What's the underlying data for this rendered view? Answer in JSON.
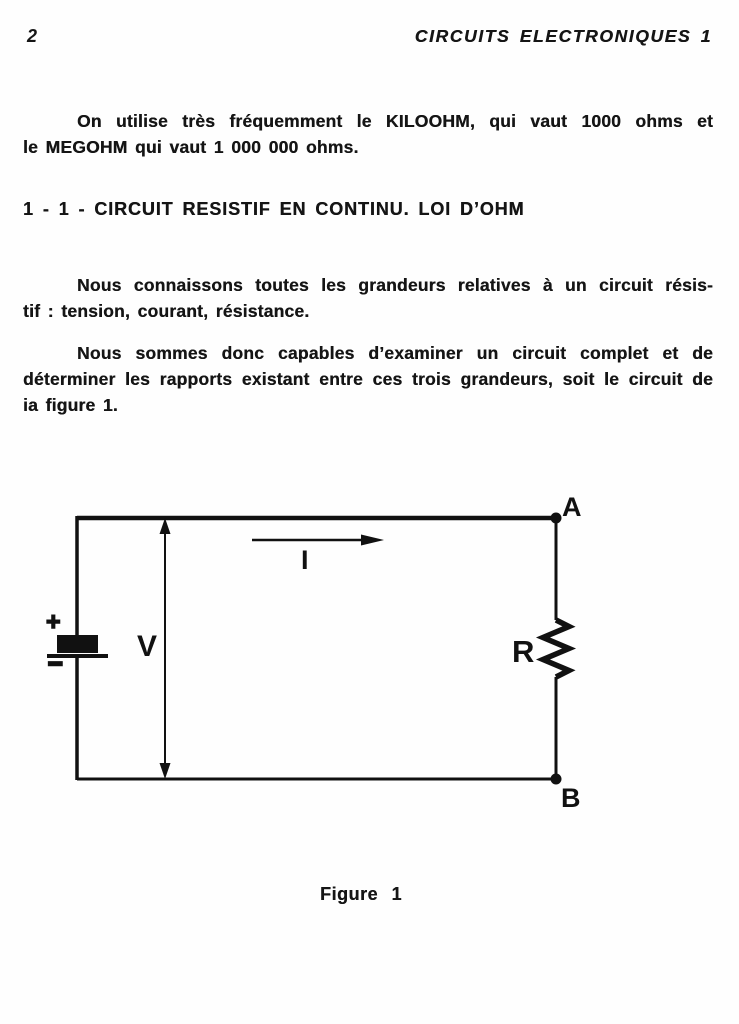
{
  "header": {
    "page_number": "2",
    "running_title": "CIRCUITS ELECTRONIQUES 1"
  },
  "intro_paragraph": {
    "line1": "On utilise très fréquemment le KILOOHM, qui vaut 1000 ohms et",
    "line2": "le MEGOHM qui vaut 1 000 000 ohms."
  },
  "section_heading": "1 - 1 - CIRCUIT RESISTIF EN CONTINU. LOI D’OHM",
  "paragraph_grandeurs": {
    "line1": "Nous connaissons toutes les grandeurs relatives à un circuit résis-",
    "line2": "tif : tension, courant, résistance."
  },
  "paragraph_circuit": {
    "line1": "Nous sommes donc capables d’examiner un circuit complet et de",
    "line2": "déterminer les rapports existant entre ces trois grandeurs, soit le circuit de",
    "line3": "ia figure 1."
  },
  "figure": {
    "caption": "Figure 1",
    "labels": {
      "node_a": "A",
      "node_b": "B",
      "voltage": "V",
      "current": "I",
      "resistance": "R",
      "battery_plus": "+",
      "battery_minus": "−"
    }
  },
  "colors": {
    "ink": "#151515",
    "paper": "#fefefe"
  }
}
